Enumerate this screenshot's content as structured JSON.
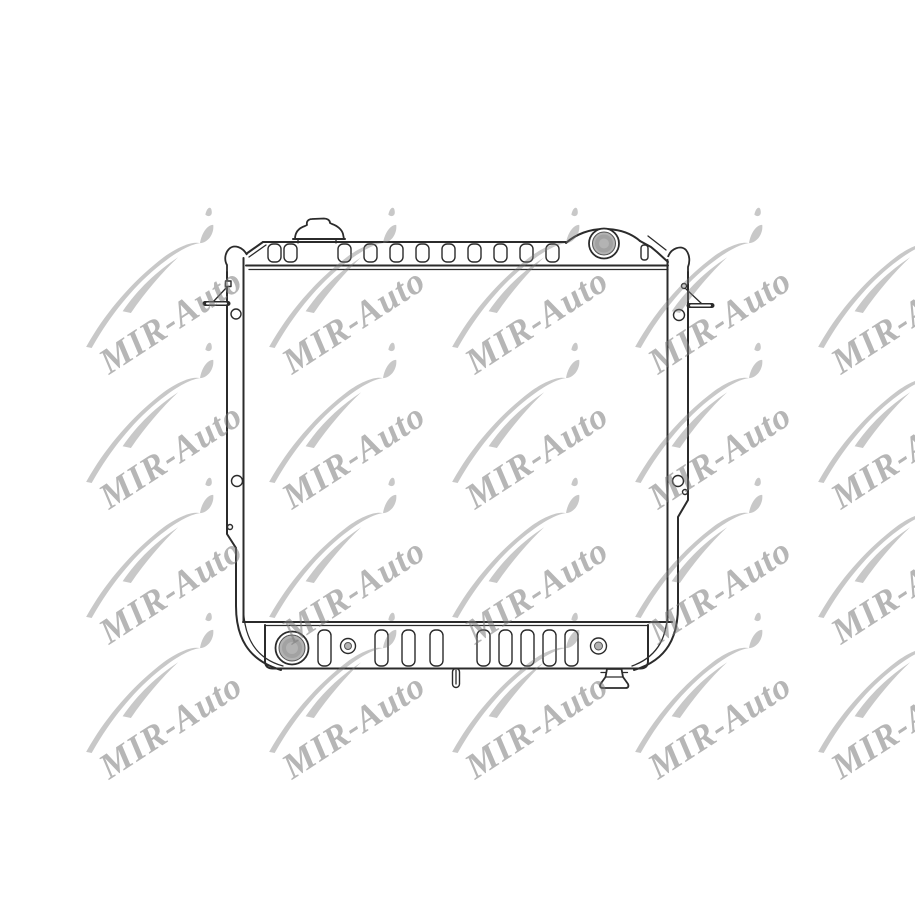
{
  "page": {
    "width": 915,
    "height": 915,
    "background": "#ffffff"
  },
  "watermark": {
    "text": "MIR-Auto",
    "color": "#7a7a7a",
    "opacity": 0.55,
    "grid": {
      "columns": [
        155,
        338,
        521,
        704,
        887
      ],
      "rows": [
        295,
        430,
        565,
        700
      ]
    }
  },
  "drawing": {
    "name": "car-radiator-line-drawing",
    "line_color": "#2b2b2b",
    "fill_color": "#ffffff",
    "port_fill": "#b3b3b3",
    "parts": [
      {
        "name": "filler-cap"
      },
      {
        "name": "top-tank-header"
      },
      {
        "name": "inlet-port"
      },
      {
        "name": "mounting-bracket-left"
      },
      {
        "name": "mounting-bracket-right"
      },
      {
        "name": "side-channel-left"
      },
      {
        "name": "side-channel-right"
      },
      {
        "name": "core"
      },
      {
        "name": "bottom-tank-header"
      },
      {
        "name": "outlet-port"
      },
      {
        "name": "drain-plug"
      },
      {
        "name": "drain-tube"
      }
    ]
  }
}
